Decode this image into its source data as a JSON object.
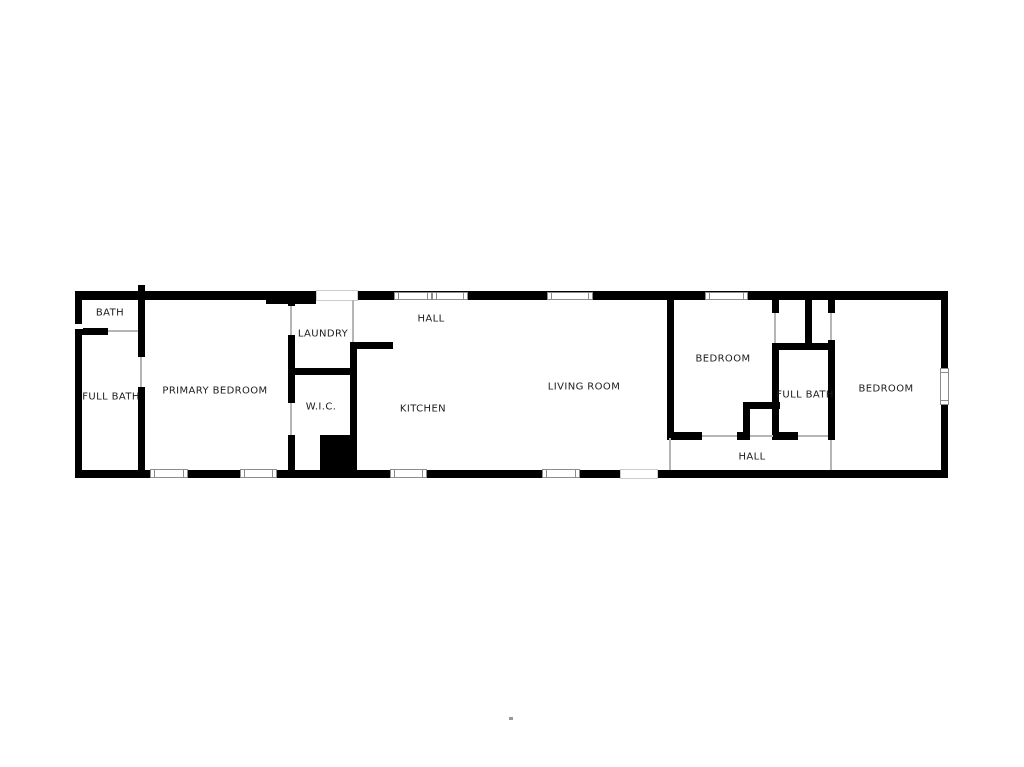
{
  "canvas": {
    "width": 1024,
    "height": 767,
    "background": "#ffffff"
  },
  "colors": {
    "wall": "#000000",
    "opening_line": "#b5b5b5",
    "window_border": "#8c8c8c",
    "window_fill": "#ffffff",
    "exterior_opening_border": "#cccccc",
    "label_text": "#1c1c1c"
  },
  "rooms": [
    {
      "id": "bath",
      "label": "BATH",
      "cx": 110,
      "cy": 313
    },
    {
      "id": "full-bath-1",
      "label": "FULL BATH",
      "cx": 111,
      "cy": 397
    },
    {
      "id": "primary-bedroom",
      "label": "PRIMARY BEDROOM",
      "cx": 215,
      "cy": 391
    },
    {
      "id": "laundry",
      "label": "LAUNDRY",
      "cx": 323,
      "cy": 334
    },
    {
      "id": "wic",
      "label": "W.I.C.",
      "cx": 321,
      "cy": 407
    },
    {
      "id": "hall-1",
      "label": "HALL",
      "cx": 431,
      "cy": 319
    },
    {
      "id": "kitchen",
      "label": "KITCHEN",
      "cx": 423,
      "cy": 409
    },
    {
      "id": "living-room",
      "label": "LIVING ROOM",
      "cx": 584,
      "cy": 387
    },
    {
      "id": "bedroom-2",
      "label": "BEDROOM",
      "cx": 723,
      "cy": 359
    },
    {
      "id": "full-bath-2",
      "label": "FULL BATH",
      "cx": 805,
      "cy": 395
    },
    {
      "id": "hall-2",
      "label": "HALL",
      "cx": 752,
      "cy": 457
    },
    {
      "id": "bedroom-3",
      "label": "BEDROOM",
      "cx": 886,
      "cy": 389
    }
  ],
  "walls": [
    {
      "name": "outer-top-wall-left",
      "x": 75,
      "y": 291,
      "w": 241,
      "h": 9
    },
    {
      "name": "outer-top-wall-right",
      "x": 358,
      "y": 291,
      "w": 590,
      "h": 9
    },
    {
      "name": "outer-bottom-wall-left",
      "x": 75,
      "y": 470,
      "w": 545,
      "h": 8
    },
    {
      "name": "outer-bottom-wall-right",
      "x": 658,
      "y": 470,
      "w": 290,
      "h": 8
    },
    {
      "name": "outer-left-wall-upper",
      "x": 75,
      "y": 291,
      "w": 7,
      "h": 33
    },
    {
      "name": "outer-left-wall-lower",
      "x": 75,
      "y": 329,
      "w": 7,
      "h": 149
    },
    {
      "name": "outer-right-wall",
      "x": 941,
      "y": 291,
      "w": 7,
      "h": 187
    },
    {
      "name": "bath-primary-wall-upper",
      "x": 138,
      "y": 285,
      "w": 7,
      "h": 72
    },
    {
      "name": "bath-primary-wall-lower",
      "x": 138,
      "y": 387,
      "w": 7,
      "h": 86
    },
    {
      "name": "bath-divider-wall",
      "x": 82,
      "y": 328,
      "w": 26,
      "h": 7
    },
    {
      "name": "top-wall-thick-section",
      "x": 266,
      "y": 291,
      "w": 50,
      "h": 13
    },
    {
      "name": "primary-east-wall-stub",
      "x": 288,
      "y": 298,
      "w": 7,
      "h": 8
    },
    {
      "name": "primary-east-wall-mid",
      "x": 288,
      "y": 335,
      "w": 7,
      "h": 68
    },
    {
      "name": "primary-east-wall-lower",
      "x": 288,
      "y": 435,
      "w": 7,
      "h": 38
    },
    {
      "name": "laundry-wic-divider-wall",
      "x": 295,
      "y": 368,
      "w": 55,
      "h": 7
    },
    {
      "name": "wic-kitchen-wall",
      "x": 350,
      "y": 342,
      "w": 7,
      "h": 136
    },
    {
      "name": "kitchen-laundry-top-wall",
      "x": 357,
      "y": 342,
      "w": 36,
      "h": 7
    },
    {
      "name": "utility-block",
      "x": 320,
      "y": 435,
      "w": 37,
      "h": 43
    },
    {
      "name": "living-bedroom-wall",
      "x": 667,
      "y": 292,
      "w": 7,
      "h": 146
    },
    {
      "name": "bedroom2-south-wall",
      "x": 667,
      "y": 432,
      "w": 35,
      "h": 8
    },
    {
      "name": "bedroom2-south-stub",
      "x": 737,
      "y": 432,
      "w": 13,
      "h": 8
    },
    {
      "name": "hall-closet-top-wall",
      "x": 743,
      "y": 402,
      "w": 37,
      "h": 7
    },
    {
      "name": "hall-closet-left-wall",
      "x": 743,
      "y": 408,
      "w": 7,
      "h": 32
    },
    {
      "name": "bath2-west-wall-stub",
      "x": 772,
      "y": 298,
      "w": 7,
      "h": 15
    },
    {
      "name": "bath2-west-wall",
      "x": 772,
      "y": 343,
      "w": 7,
      "h": 97
    },
    {
      "name": "closet-divider-wall",
      "x": 805,
      "y": 298,
      "w": 7,
      "h": 52
    },
    {
      "name": "bath2-north-wall",
      "x": 772,
      "y": 343,
      "w": 61,
      "h": 7
    },
    {
      "name": "bath2-east-wall-stub",
      "x": 828,
      "y": 298,
      "w": 7,
      "h": 15
    },
    {
      "name": "bath2-east-wall",
      "x": 828,
      "y": 340,
      "w": 7,
      "h": 100
    },
    {
      "name": "bath2-south-wall",
      "x": 773,
      "y": 432,
      "w": 25,
      "h": 8
    }
  ],
  "windows": [
    {
      "name": "window-top-kitchen-a",
      "x": 394,
      "y": 292,
      "w": 38,
      "h": 8,
      "orient": "h"
    },
    {
      "name": "window-top-kitchen-b",
      "x": 432,
      "y": 292,
      "w": 36,
      "h": 8,
      "orient": "h"
    },
    {
      "name": "window-top-living-room",
      "x": 547,
      "y": 292,
      "w": 46,
      "h": 8,
      "orient": "h"
    },
    {
      "name": "window-top-bedroom2",
      "x": 705,
      "y": 292,
      "w": 43,
      "h": 8,
      "orient": "h"
    },
    {
      "name": "window-bottom-primary-a",
      "x": 150,
      "y": 469,
      "w": 38,
      "h": 9,
      "orient": "h"
    },
    {
      "name": "window-bottom-primary-b",
      "x": 240,
      "y": 469,
      "w": 37,
      "h": 9,
      "orient": "h"
    },
    {
      "name": "window-bottom-kitchen",
      "x": 390,
      "y": 469,
      "w": 37,
      "h": 9,
      "orient": "h"
    },
    {
      "name": "window-bottom-living-room",
      "x": 542,
      "y": 469,
      "w": 38,
      "h": 9,
      "orient": "h"
    },
    {
      "name": "window-right-bedroom3",
      "x": 940,
      "y": 368,
      "w": 9,
      "h": 37,
      "orient": "v"
    }
  ],
  "exterior_openings": [
    {
      "name": "side-entry-opening",
      "x": 316,
      "y": 290,
      "w": 42,
      "h": 11
    },
    {
      "name": "main-entry-opening",
      "x": 620,
      "y": 469,
      "w": 38,
      "h": 10
    }
  ],
  "wall_gaps": [
    {
      "name": "left-wall-notch",
      "x": 74,
      "y": 324,
      "w": 9,
      "h": 5
    }
  ],
  "door_openings": [
    {
      "name": "bath-door-opening",
      "x": 108,
      "y": 330,
      "len": 30,
      "orient": "h"
    },
    {
      "name": "fullbath1-door-opening",
      "x": 140,
      "y": 357,
      "len": 30,
      "orient": "v"
    },
    {
      "name": "primary-bedroom-door-opening",
      "x": 290,
      "y": 306,
      "len": 29,
      "orient": "v"
    },
    {
      "name": "wic-door-opening",
      "x": 290,
      "y": 403,
      "len": 32,
      "orient": "v"
    },
    {
      "name": "laundry-hall-opening",
      "x": 352,
      "y": 300,
      "len": 42,
      "orient": "v"
    },
    {
      "name": "bedroom2-door-opening",
      "x": 702,
      "y": 435,
      "len": 35,
      "orient": "h"
    },
    {
      "name": "hall-closet-opening",
      "x": 750,
      "y": 435,
      "len": 23,
      "orient": "h"
    },
    {
      "name": "bedroom2-closet-opening",
      "x": 774,
      "y": 313,
      "len": 30,
      "orient": "v"
    },
    {
      "name": "bedroom3-closet-opening",
      "x": 830,
      "y": 313,
      "len": 27,
      "orient": "v"
    },
    {
      "name": "fullbath2-door-opening",
      "x": 798,
      "y": 435,
      "len": 30,
      "orient": "h"
    },
    {
      "name": "bedroom3-door-opening",
      "x": 830,
      "y": 440,
      "len": 30,
      "orient": "v"
    },
    {
      "name": "hall-living-room-opening",
      "x": 669,
      "y": 438,
      "len": 32,
      "orient": "v"
    }
  ],
  "artifact_dot": {
    "x": 509,
    "y": 717,
    "w": 4,
    "h": 3
  }
}
